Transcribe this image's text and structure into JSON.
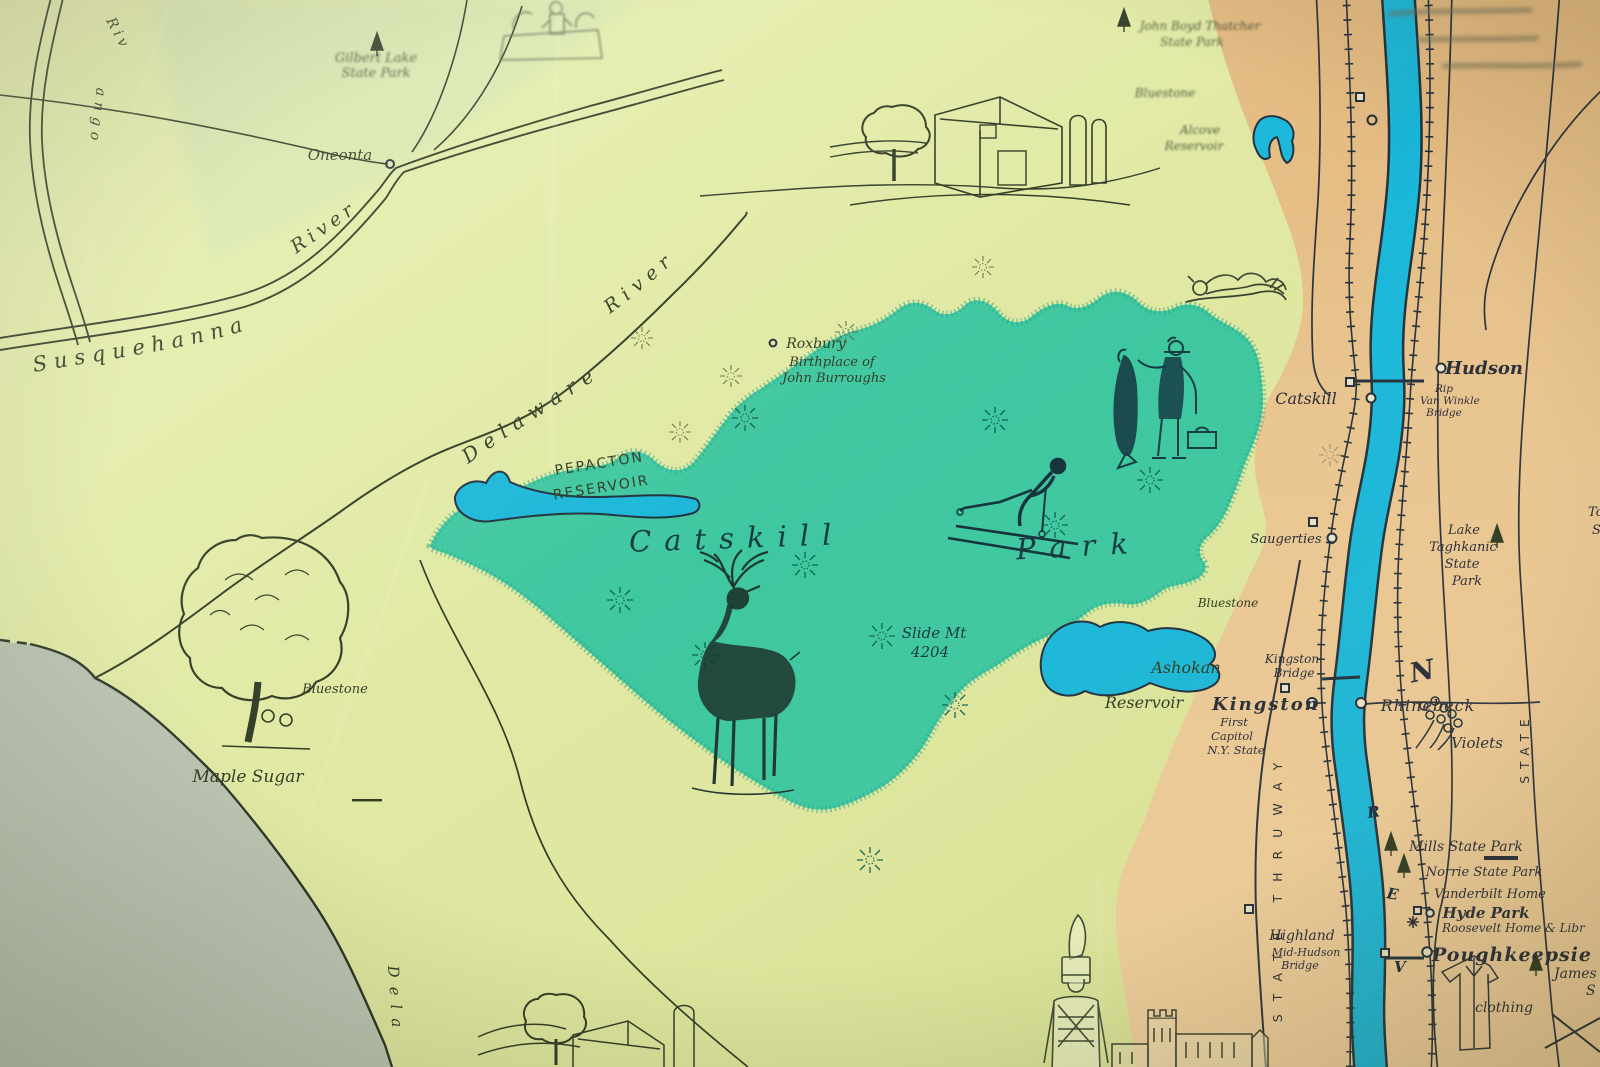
{
  "map": {
    "description": "Photograph of a vintage hand-drawn pictorial map of the Catskill Park and Hudson River valley, New York",
    "colors": {
      "paper_yellow": "#dfe7a0",
      "park_teal": "#3ec7a0",
      "east_tan": "#e9c28d",
      "water_cyan": "#1ab7d9",
      "pennsylvania_gray": "#b9c3b0",
      "ink": "#2e3a22",
      "ink_dark": "#262c37",
      "park_ink": "#0e745a"
    },
    "labels": {
      "gilbert_lake_1": "Gilbert Lake",
      "gilbert_lake_2": "State Park",
      "oneonta": "Oneonta",
      "maple_sugar": "Maple Sugar",
      "susquehanna": "Susquehanna",
      "susq_river": "River",
      "chenango_riv": "Riv",
      "chenango_ango": "ango",
      "delaware": "Delaware",
      "delaware_river": "River",
      "delaware_bottom": "Dela",
      "pepacton_1": "PEPACTON",
      "pepacton_2": "RESERVOIR",
      "roxbury": "Roxbury",
      "birthplace_1": "Birthplace of",
      "birthplace_2": "John Burroughs",
      "catskill_word": "Catskill",
      "park_word": "Park",
      "slide_mt_1": "Slide Mt",
      "slide_mt_2": "4204",
      "ashokan": "Ashokan",
      "ashokan_res": "Reservoir",
      "bluestone_sw": "Bluestone",
      "bluestone_ne": "Bluestone",
      "bluestone_mid": "Bluestone",
      "alcove_1": "Alcove",
      "alcove_2": "Reservoir",
      "thatcher_1": "John Boyd Thatcher",
      "thatcher_2": "State Park",
      "catskill_town": "Catskill",
      "hudson_town": "Hudson",
      "rvw_1": "Rip",
      "rvw_2": "Van Winkle",
      "rvw_3": "Bridge",
      "saugerties": "Saugerties",
      "taghkanic_1": "Lake",
      "taghkanic_2": "Taghkanic",
      "taghkanic_3": "State",
      "taghkanic_4": "Park",
      "to_edge_1": "To",
      "to_edge_2": "S",
      "kingston_br_1": "Kingston",
      "kingston_br_2": "Bridge",
      "kingston": "Kingston",
      "first_cap_1": "First",
      "first_cap_2": "Capitol",
      "first_cap_3": "N.Y. State",
      "rhinebeck": "Rhinebeck",
      "compass_n": "N",
      "violets": "Violets",
      "mills": "Mills State Park",
      "norrie": "Norrie State Park",
      "vanderbilt": "Vanderbilt Home",
      "hyde_park": "Hyde Park",
      "roosevelt": "Roosevelt Home & Libr",
      "poughkeepsie": "Poughkeepsie",
      "james": "James",
      "james_s": "S",
      "clothing": "clothing",
      "highland": "Highland",
      "midhudson_1": "Mid-Hudson",
      "midhudson_2": "Bridge",
      "state_thruway": "STATE THRUWAY",
      "state_taconic": "STATE",
      "river_letter_r": "R",
      "river_letter_e": "E",
      "river_letter_v": "V"
    }
  }
}
